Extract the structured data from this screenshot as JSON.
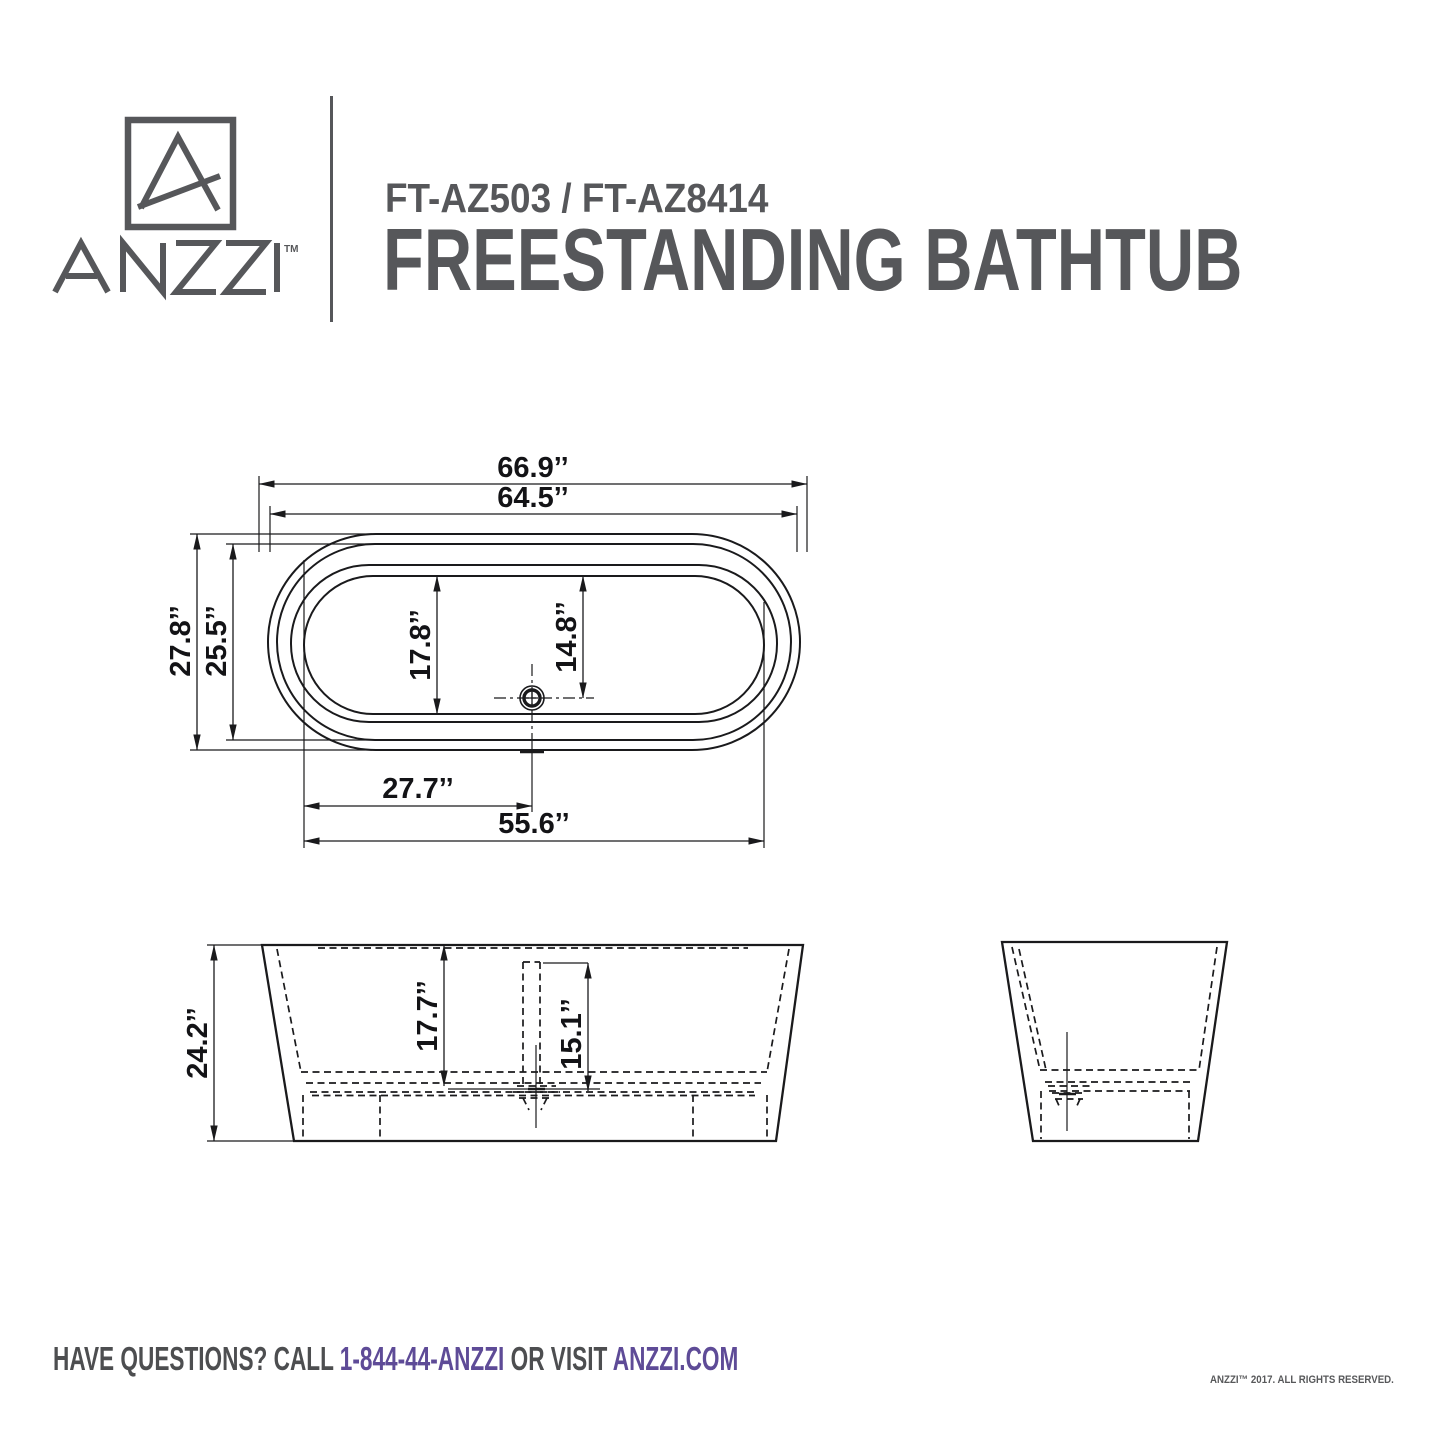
{
  "header": {
    "brand": "ANZZI",
    "trademark": "TM",
    "model": "FT-AZ503 / FT-AZ8414",
    "product": "FREESTANDING BATHTUB"
  },
  "dims": {
    "top": {
      "overall_length": "66.9’’",
      "rim_length": "64.5’’",
      "overall_width": "27.8’’",
      "rim_width": "25.5’’",
      "basin_width": "17.8’’",
      "drain_offset_width": "14.8’’",
      "drain_offset_length": "27.7’’",
      "basin_length": "55.6’’"
    },
    "front": {
      "overall_height": "24.2’’",
      "inner_depth": "17.7’’",
      "drain_depth": "15.1’’"
    }
  },
  "footer": {
    "prefix": "HAVE QUESTIONS? CALL ",
    "phone": "1-844-44-ANZZI",
    "middle": " OR VISIT ",
    "website": "ANZZI.COM",
    "copyright": "ANZZI™ 2017. ALL RIGHTS RESERVED."
  },
  "colors": {
    "brand_gray": "#56575a",
    "brand_purple": "#5e4b97",
    "line_black": "#1a1a1c"
  }
}
